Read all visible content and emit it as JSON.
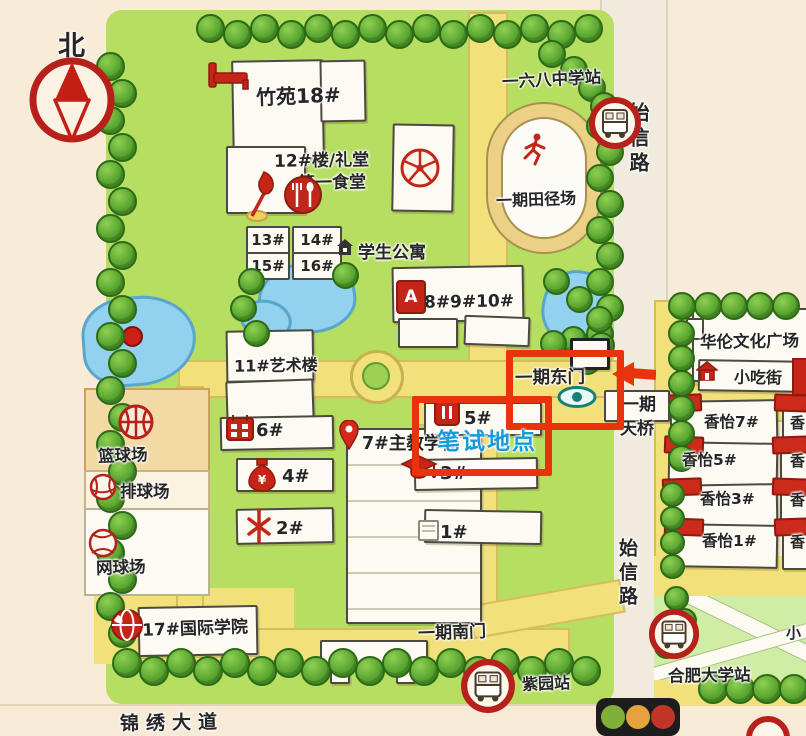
{
  "colors": {
    "annotation_red": "#e8330e",
    "test_blue": "#149bdc"
  },
  "compass": {
    "north": "北"
  },
  "campus": {
    "zhuyuan": "竹苑18#",
    "hall12_line1": "12#楼/礼堂",
    "hall12_line2": "第一食堂",
    "d13": "13#",
    "d14": "14#",
    "d15": "15#",
    "d16": "16#",
    "dorm": "学生公寓",
    "track": "一期田径场",
    "b8910": "8#9#10#",
    "badge_a": "A",
    "art11": "11#艺术楼",
    "b6": "6#",
    "b5": "5#",
    "b4": "4#",
    "b3": "3#",
    "b2": "2#",
    "b1": "1#",
    "main7": "7#主教学楼",
    "intl17": "17#国际学院",
    "basketball": "篮球场",
    "volleyball": "排球场",
    "tennis": "网球场",
    "east_gate": "一期东门",
    "south_gate": "一期南门",
    "bridge_line1": "一期",
    "bridge_line2": "天桥"
  },
  "roads": {
    "shixin_top": "始信路",
    "shixin_bottom": "始信路",
    "jinxiu": "锦绣大道"
  },
  "stations": {
    "school168": "一六八中学站",
    "ziyuan": "紫园站",
    "hefei_univ": "合肥大学站"
  },
  "east_area": {
    "plaza": "华伦文化广场",
    "snack": "小吃街",
    "xy7": "香怡7#",
    "xy5": "香怡5#",
    "xy3": "香怡3#",
    "xy1": "香怡1#",
    "partial": "香",
    "xiao_partial": "小"
  },
  "annotation": {
    "written_test": "笔试地点"
  }
}
